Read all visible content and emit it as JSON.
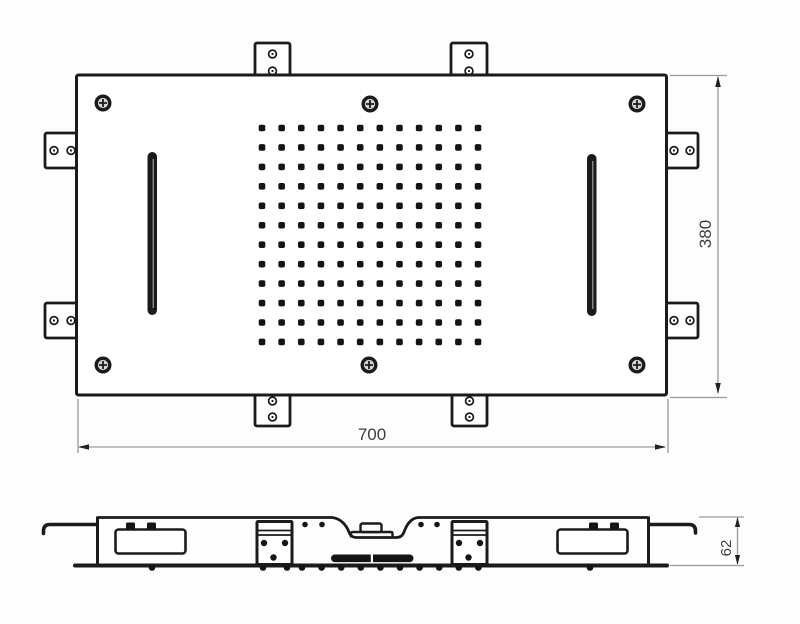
{
  "drawing": {
    "meta": {
      "type": "technical-drawing",
      "subject": "ceiling shower head panel",
      "views": [
        "top view",
        "side section"
      ]
    },
    "dimensions": {
      "width": "700",
      "height": "380",
      "depth": "62"
    },
    "colors": {
      "line": "#1b1b1b",
      "dim_line": "#9a9a9a",
      "arrow": "#222222",
      "text": "#3d3d3d",
      "fill": "#ffffff",
      "dot": "#141414",
      "background": "#fdfdfd"
    },
    "top_view": {
      "plate": {
        "x": 76.5,
        "y": 75,
        "w": 590,
        "h": 320
      },
      "nozzle_grid": {
        "cols": 12,
        "rows": 12,
        "x0": 262,
        "y0": 128,
        "dx": 19.64,
        "dy": 19.45,
        "dot_size": 6.6
      },
      "screws": [
        [
          103,
          103
        ],
        [
          370,
          104
        ],
        [
          637,
          104
        ],
        [
          103,
          365
        ],
        [
          369,
          365
        ],
        [
          637,
          365
        ]
      ],
      "tabs": [
        {
          "x": 255,
          "y": 43,
          "w": 35,
          "h": 33,
          "holes": [
            [
              272.5,
              54
            ],
            [
              272.5,
              71
            ]
          ]
        },
        {
          "x": 451,
          "y": 43,
          "w": 36,
          "h": 33,
          "holes": [
            [
              469,
              54
            ],
            [
              469,
              71
            ]
          ]
        },
        {
          "x": 255,
          "y": 394,
          "w": 35,
          "h": 32,
          "holes": [
            [
              272.5,
              401
            ],
            [
              272.5,
              417
            ]
          ]
        },
        {
          "x": 452,
          "y": 394,
          "w": 35,
          "h": 32,
          "holes": [
            [
              469.5,
              401
            ],
            [
              469.5,
              417
            ]
          ]
        },
        {
          "x": 45,
          "y": 133,
          "w": 33,
          "h": 35,
          "holes": [
            [
              54,
              150.5
            ],
            [
              71,
              150.5
            ]
          ]
        },
        {
          "x": 45,
          "y": 303,
          "w": 33,
          "h": 35,
          "holes": [
            [
              54,
              320.5
            ],
            [
              71,
              320.5
            ]
          ]
        },
        {
          "x": 666,
          "y": 133,
          "w": 32,
          "h": 35,
          "holes": [
            [
              674,
              150.5
            ],
            [
              690,
              150.5
            ]
          ]
        },
        {
          "x": 666,
          "y": 303,
          "w": 32,
          "h": 35,
          "holes": [
            [
              674,
              320.5
            ],
            [
              690,
              320.5
            ]
          ]
        }
      ],
      "slots": [
        {
          "x": 147.5,
          "y": 152,
          "w": 9.5,
          "h": 163
        },
        {
          "x": 587,
          "y": 154,
          "w": 9.5,
          "h": 162
        }
      ]
    },
    "profile_view": {
      "ticks_y": 567.5,
      "ticks_x": [
        152,
        263,
        287,
        302,
        321.6,
        341.2,
        360.8,
        380.4,
        400,
        419.6,
        439.2,
        458.8,
        478.4,
        590
      ],
      "surface_dots": [
        [
          305,
          524.5
        ],
        [
          322,
          524.5
        ],
        [
          421,
          524.5
        ],
        [
          437,
          524.5
        ]
      ],
      "brackets": [
        {
          "x": 257,
          "y": 521.5,
          "w": 35,
          "h": 43,
          "dots": [
            [
              264,
              543
            ],
            [
              285,
              543
            ],
            [
              273.5,
              557.5
            ]
          ]
        },
        {
          "x": 452,
          "y": 521.5,
          "w": 35,
          "h": 43,
          "dots": [
            [
              459,
              543
            ],
            [
              480,
              543
            ],
            [
              468.5,
              557.5
            ]
          ]
        }
      ],
      "pockets": [
        {
          "x": 115.5,
          "y": 529.5,
          "w": 70,
          "h": 24,
          "bumps": [
            [
              126,
              522.5
            ],
            [
              147,
              522.5
            ]
          ]
        },
        {
          "x": 557.5,
          "y": 529.5,
          "w": 70,
          "h": 24,
          "bumps": [
            [
              589,
              522.5
            ],
            [
              610,
              522.5
            ]
          ]
        }
      ]
    }
  }
}
